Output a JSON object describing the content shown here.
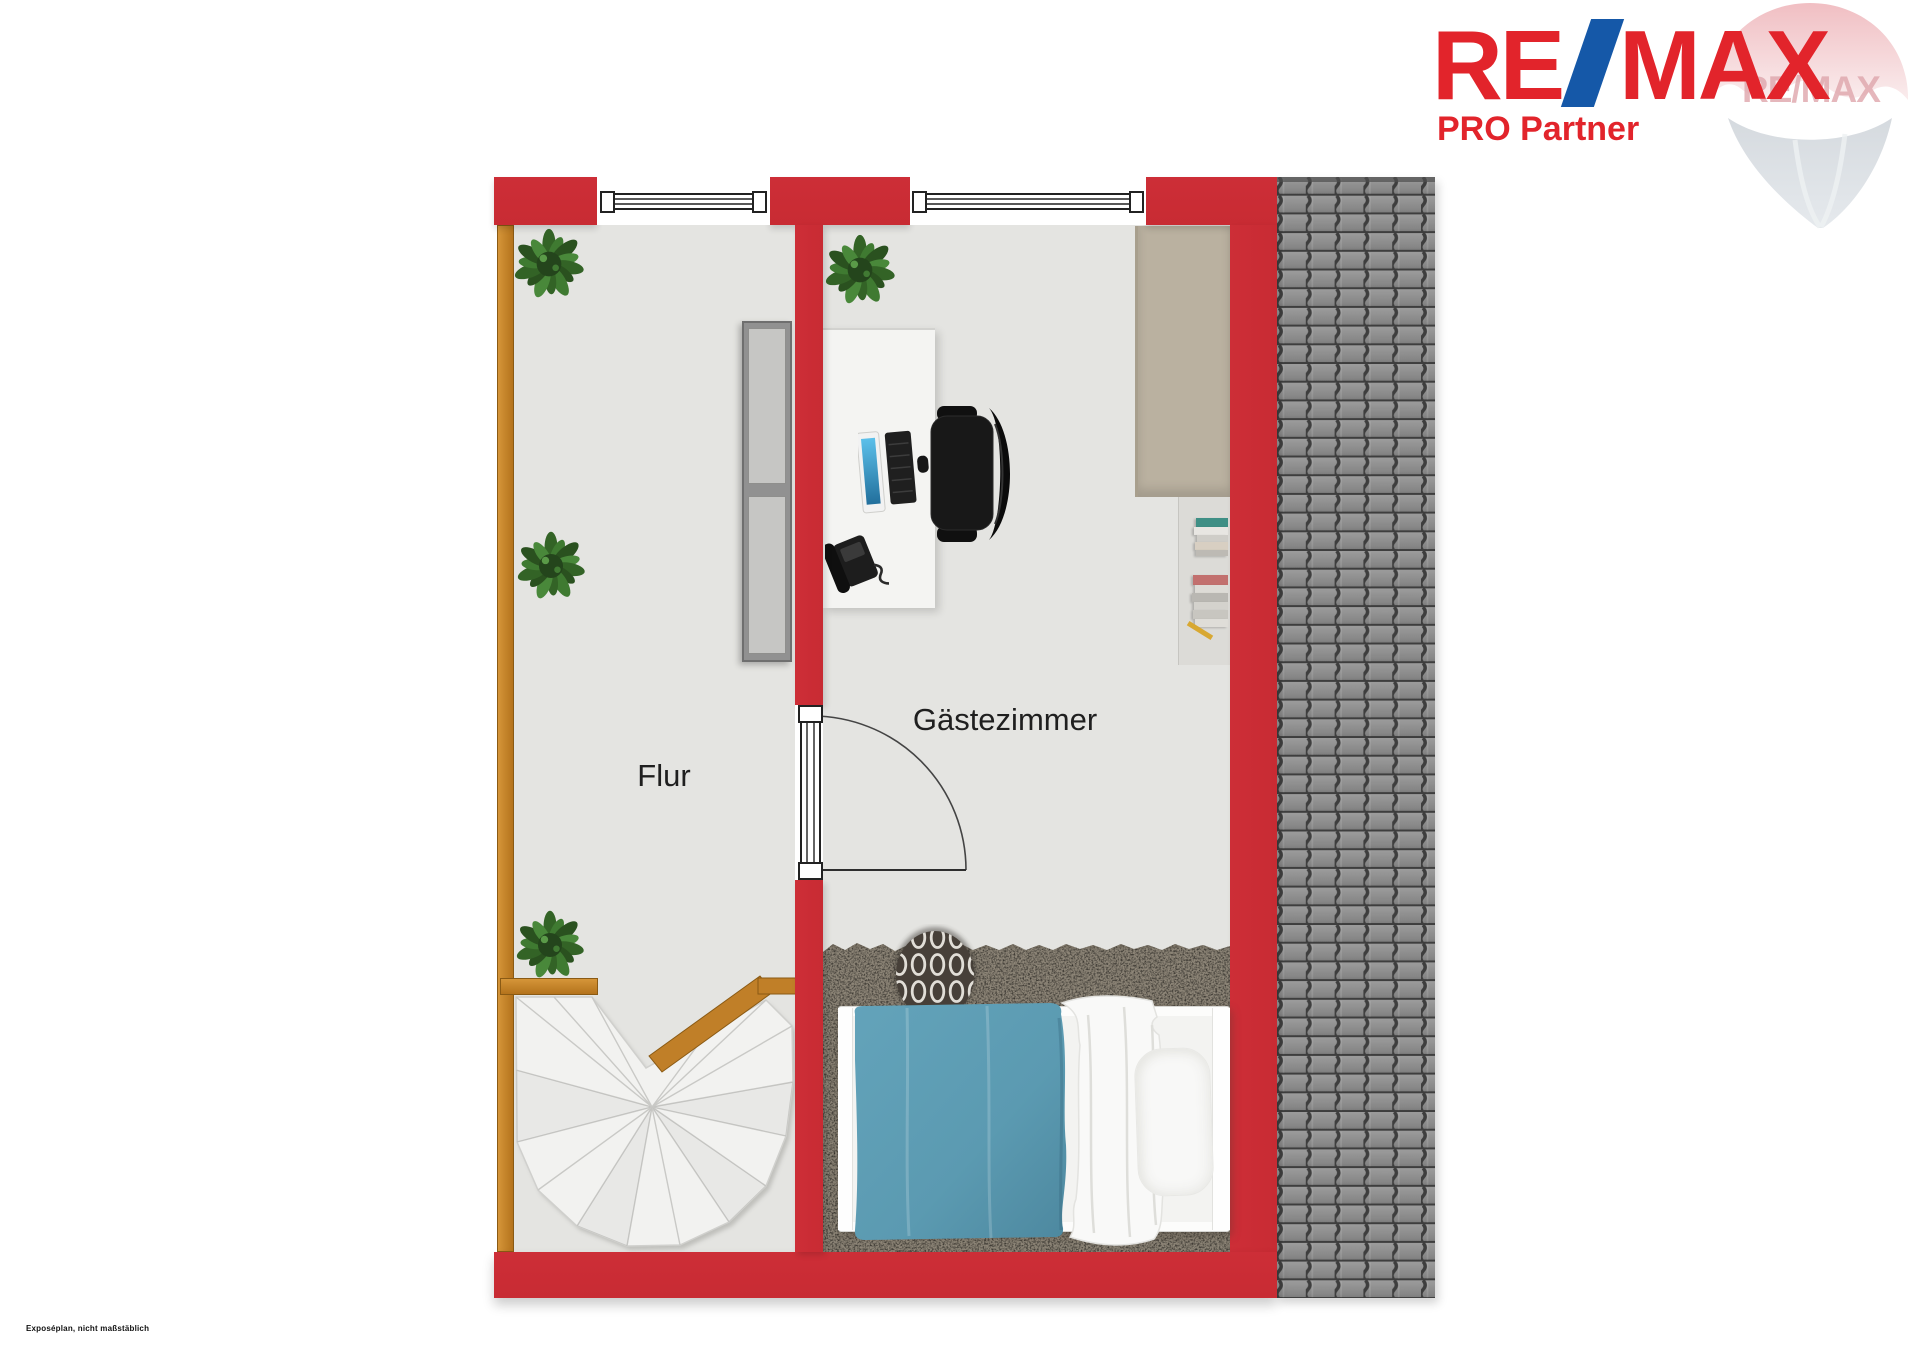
{
  "header": {
    "logo": {
      "re": "RE",
      "slash": "/",
      "max": "MAX",
      "subtitle": "PRO Partner",
      "watermark_text": "RE/MAX"
    }
  },
  "plan": {
    "rooms": [
      {
        "label": "Flur"
      },
      {
        "label": "Gästezimmer"
      }
    ]
  },
  "footer": {
    "disclaimer": "Exposéplan, nicht maßstäblich"
  },
  "colors": {
    "wall_red": "#c82b33",
    "logo_red": "#e2242b",
    "slash_blue": "#1558a8",
    "wood": "#c07f28",
    "floor": "#e4e4e1",
    "tan_niche": "#bab1a0",
    "carpet": "#8e8678",
    "blanket_blue": "#5b9ab1",
    "roof_tile": "#8d8d8d",
    "roof_gap": "#3e3e3e"
  }
}
